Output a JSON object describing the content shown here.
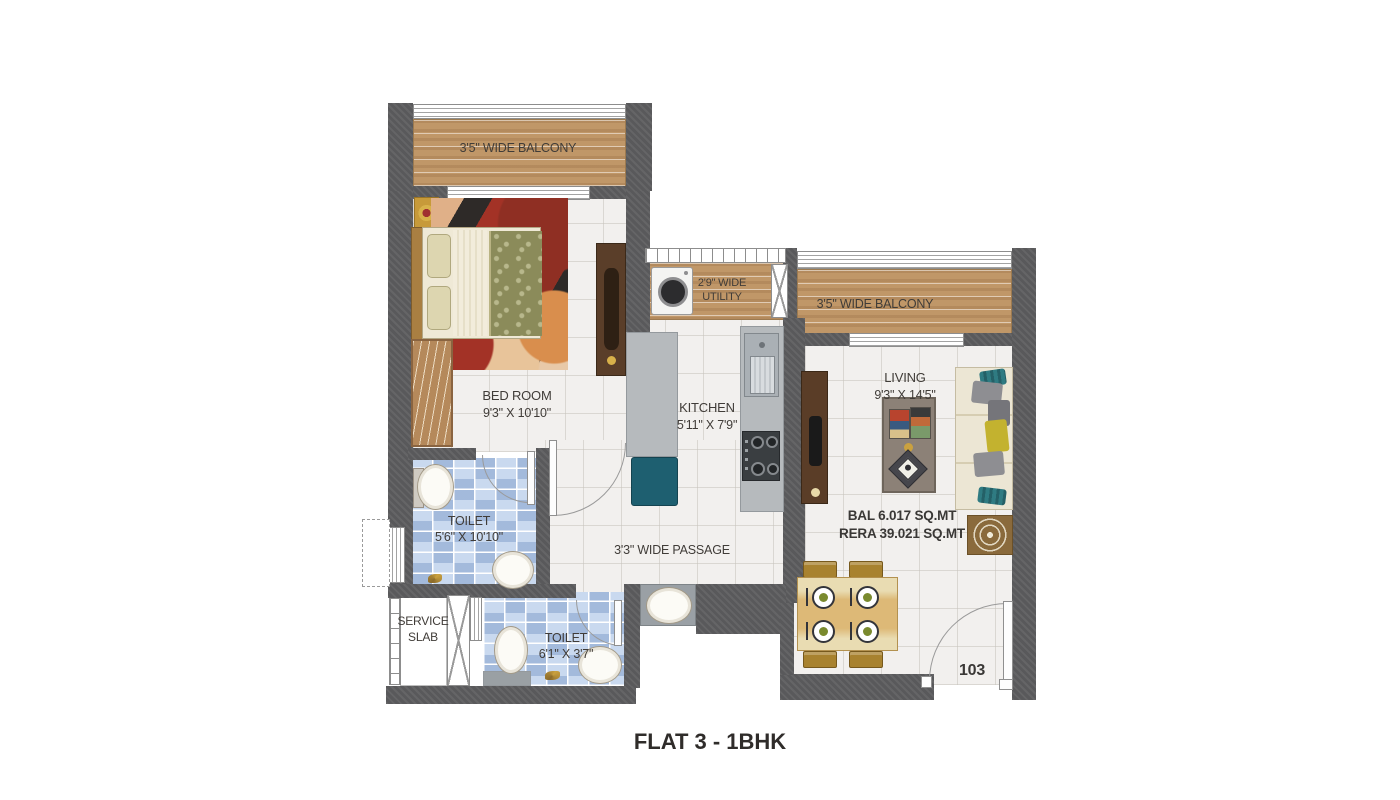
{
  "plan": {
    "title": "FLAT 3 - 1BHK",
    "flat_number": "103",
    "areas": {
      "balcony": "BAL 6.017 SQ.MT",
      "rera": "RERA  39.021 SQ.MT"
    },
    "rooms": {
      "balcony_top": {
        "label": "3'5\" WIDE BALCONY"
      },
      "balcony_right": {
        "label": "3'5\" WIDE BALCONY"
      },
      "utility": {
        "line1": "2'9\" WIDE",
        "line2": "UTILITY"
      },
      "bedroom": {
        "name": "BED ROOM",
        "size": "9'3\" X 10'10\""
      },
      "kitchen": {
        "name": "KITCHEN",
        "size": "5'11\" X 7'9\""
      },
      "living": {
        "name": "LIVING",
        "size": "9'3\" X 14'5\""
      },
      "toilet_main": {
        "name": "TOILET",
        "size": "5'6\" X 10'10\""
      },
      "toilet_common": {
        "name": "TOILET",
        "size": "6'1\" X 3'7\""
      },
      "passage": {
        "label": "3'3\" WIDE PASSAGE"
      },
      "service_slab": {
        "line1": "SERVICE",
        "line2": "SLAB"
      }
    },
    "colors": {
      "wall": "#59595b",
      "wood": "#c09768",
      "marble": "#f2f0ee",
      "toilet_tile": "#c9d9ef",
      "counter": "#b6babd",
      "accent_teal": "#1e5f70",
      "dining_gold": "#dab36e"
    }
  }
}
